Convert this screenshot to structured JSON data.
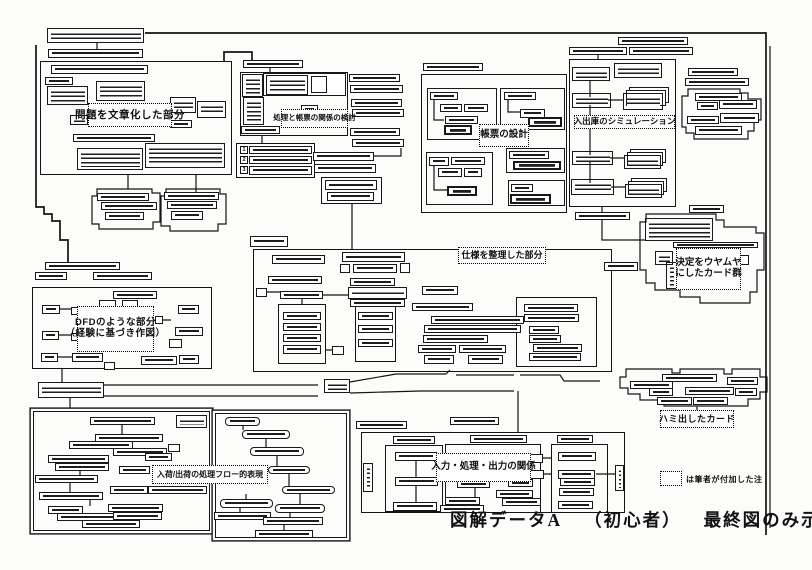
{
  "figure": {
    "caption": {
      "part1": "図解データA",
      "part2": "（初心者）",
      "part3": "最終図のみ示す"
    },
    "legend_note": "は筆者が付加した注"
  },
  "labels": {
    "problem": "問題を文章化した部分",
    "process_report": "処理と帳票の関係の検討",
    "report_design": "帳票の設計",
    "warehouse_sim": "入出庫のシミュレーション",
    "vague_cards_line1": "決定をウヤムヤ",
    "vague_cards_line2": "にしたカード群",
    "spec": "仕様を整理した部分",
    "dfd_line1": "DFDのような部分",
    "dfd_line2": "（経験に基づき作図）",
    "flow": "入荷/出荷の処理フロー的表現",
    "io": "入力・処理・出力の関係",
    "overflow_cards": "ハミ出したカード"
  },
  "numbered_list": {
    "n1": "1",
    "n2": "2",
    "n3": "3"
  },
  "ink_color": "#141414",
  "paper_color": "#fcfcfa"
}
